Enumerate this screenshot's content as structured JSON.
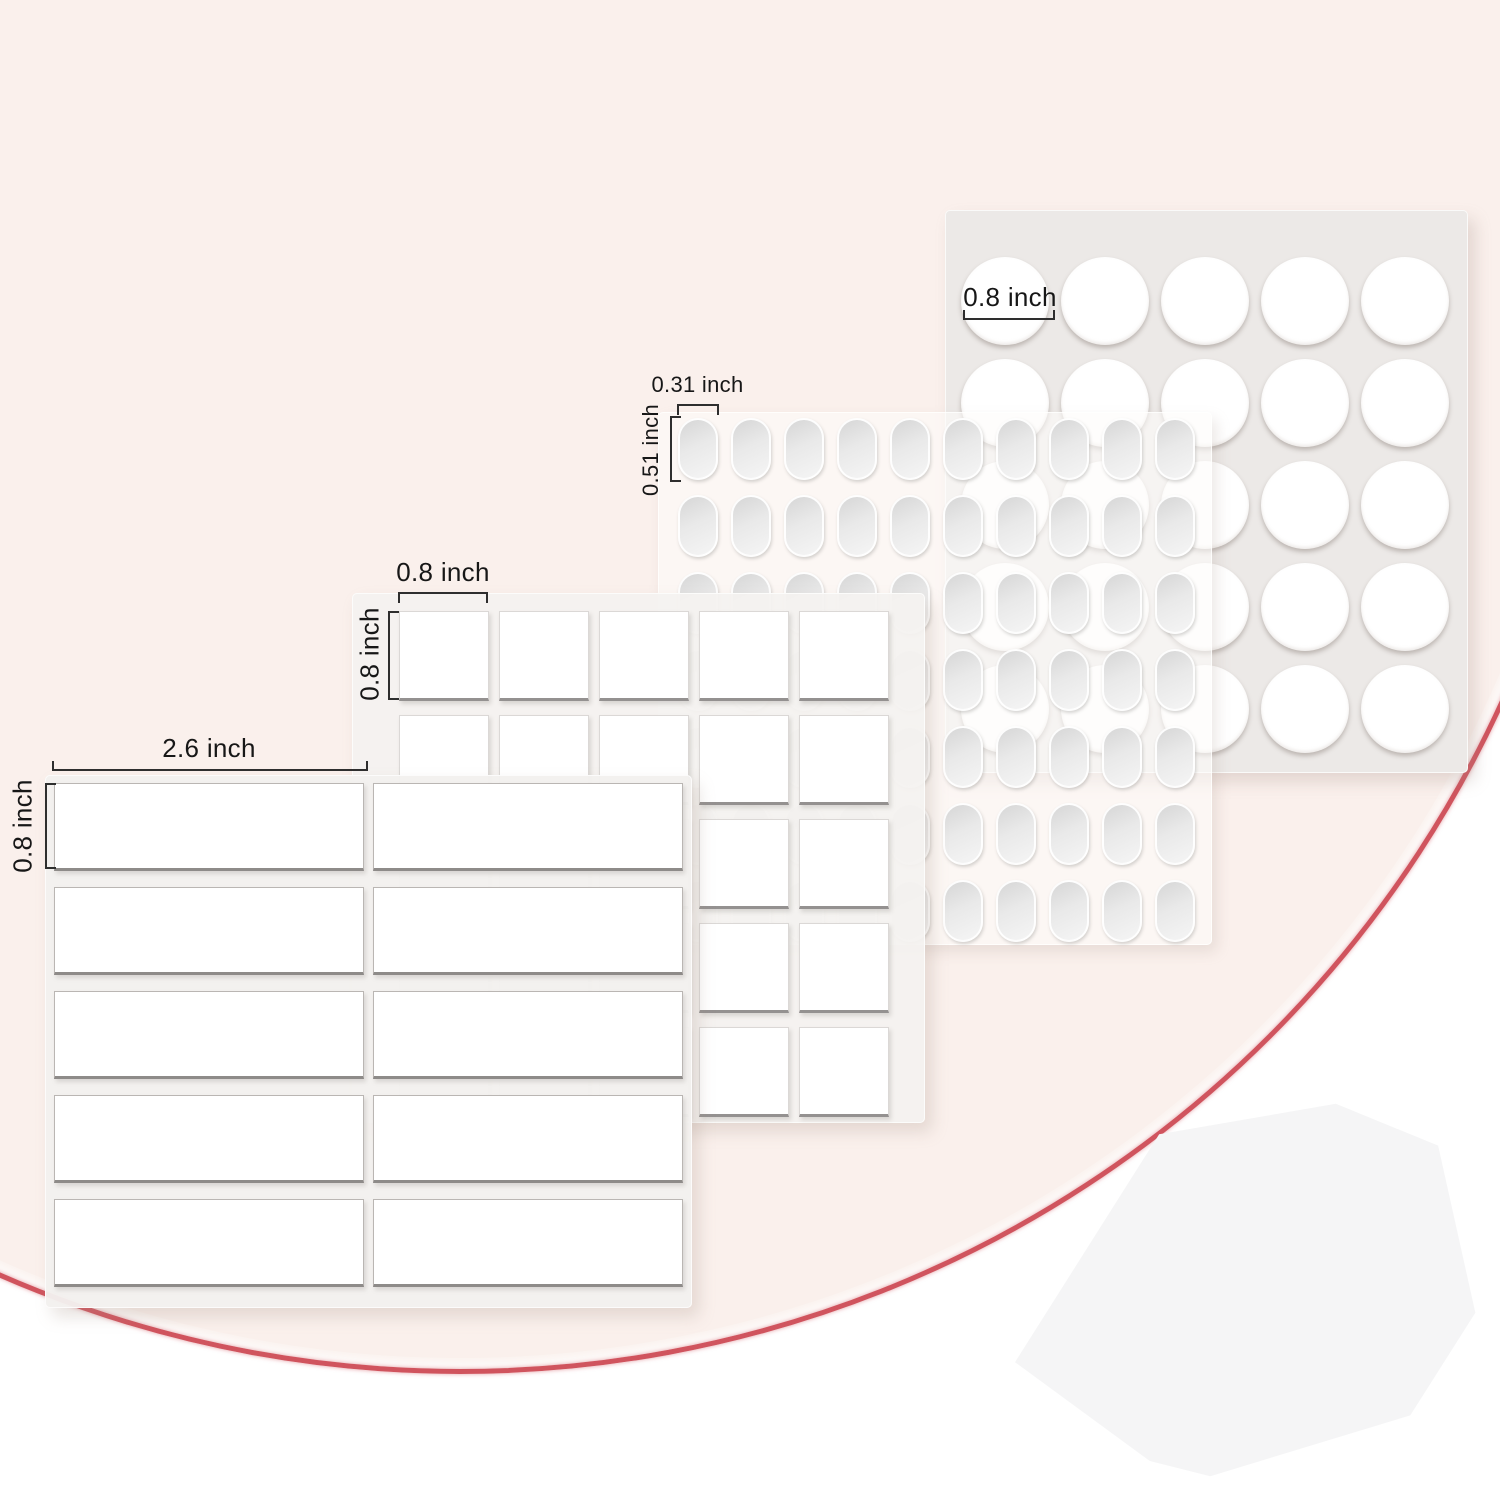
{
  "scene": {
    "background_color": "#ffffff",
    "backdrop_color": "#faf0ec",
    "accent_curve_color": "#d0545e",
    "heptagon_color": "#f5f5f6"
  },
  "sheets": [
    {
      "id": "round-stickers",
      "shape": "circle",
      "rows": 5,
      "cols": 5,
      "count": 25,
      "width_label": "0.8 inch"
    },
    {
      "id": "oval-stickers",
      "shape": "oval",
      "rows": 7,
      "cols": 10,
      "count": 70,
      "width_label": "0.31 inch",
      "height_label": "0.51 inch"
    },
    {
      "id": "square-stickers",
      "shape": "square",
      "rows": 5,
      "cols": 5,
      "count": 25,
      "width_label": "0.8 inch",
      "height_label": "0.8 inch"
    },
    {
      "id": "strip-stickers",
      "shape": "rectangle",
      "rows": 5,
      "cols": 2,
      "count": 10,
      "width_label": "2.6 inch",
      "height_label": "0.8 inch"
    }
  ]
}
